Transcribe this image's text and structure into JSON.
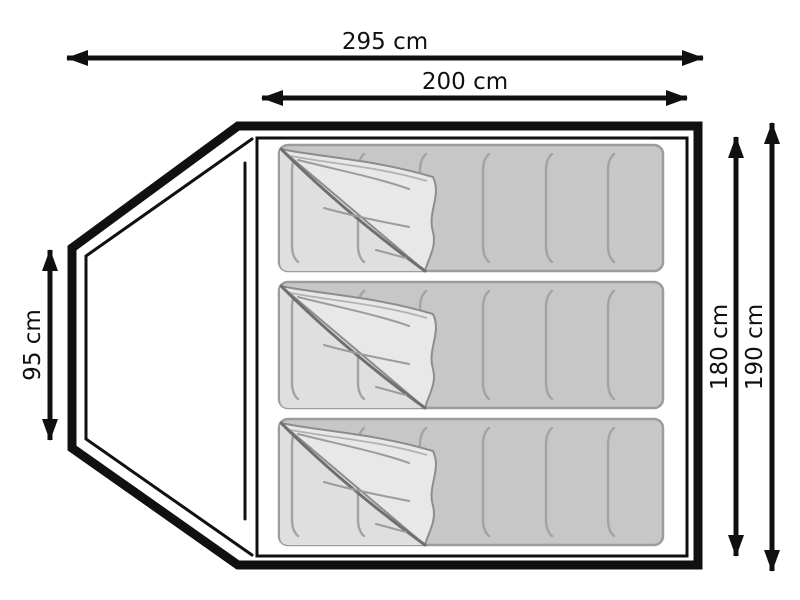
{
  "diagram": {
    "subject": "tent-floor-plan-top-view",
    "dimensions": {
      "total_width": {
        "label": "295 cm"
      },
      "inner_width": {
        "label": "200 cm"
      },
      "vestibule_side": {
        "label": "95 cm"
      },
      "inner_length": {
        "label": "180 cm"
      },
      "outer_length": {
        "label": "190 cm"
      }
    },
    "sleeping_bags": {
      "count": 3
    },
    "colors": {
      "outline": "#101010",
      "bag_fill": "#c7c7c7",
      "bag_border": "#9c9c9c",
      "bag_seam": "#a3a3a3",
      "flap_fill": "#e8e8e8",
      "flap_edge": "#8d8d8d",
      "fold_line": "#6f6f6f",
      "underlay_fill": "#dfdfdf",
      "background": "#ffffff"
    }
  }
}
